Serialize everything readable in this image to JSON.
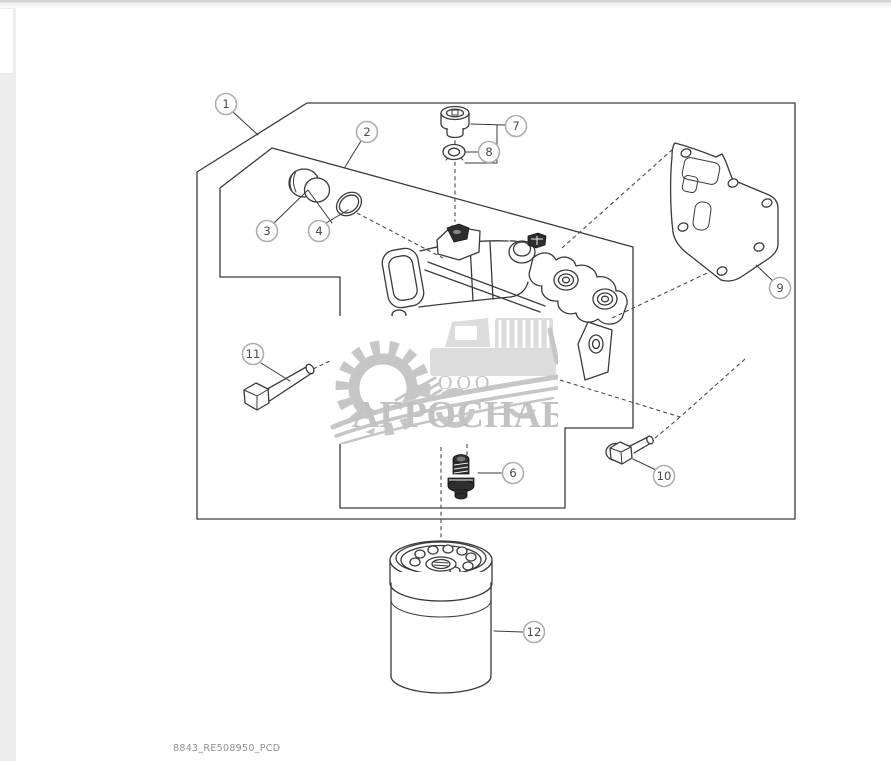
{
  "page": {
    "footer_text": "8843_RE508950_PCD"
  },
  "watermark": {
    "prefix": "ООО",
    "name": "АГРОСНАБ"
  },
  "colors": {
    "line": "#3a3a3a",
    "callout_ring": "#aeaeae",
    "callout_text": "#4a4a4a",
    "watermark_gray": "#c6c6c6",
    "footer_gray": "#8f8f8f"
  },
  "callouts": {
    "c1": "1",
    "c2": "2",
    "c3": "3",
    "c4": "4",
    "c6": "6",
    "c7": "7",
    "c8": "8",
    "c9": "9",
    "c10": "10",
    "c11": "11",
    "c12": "12"
  }
}
